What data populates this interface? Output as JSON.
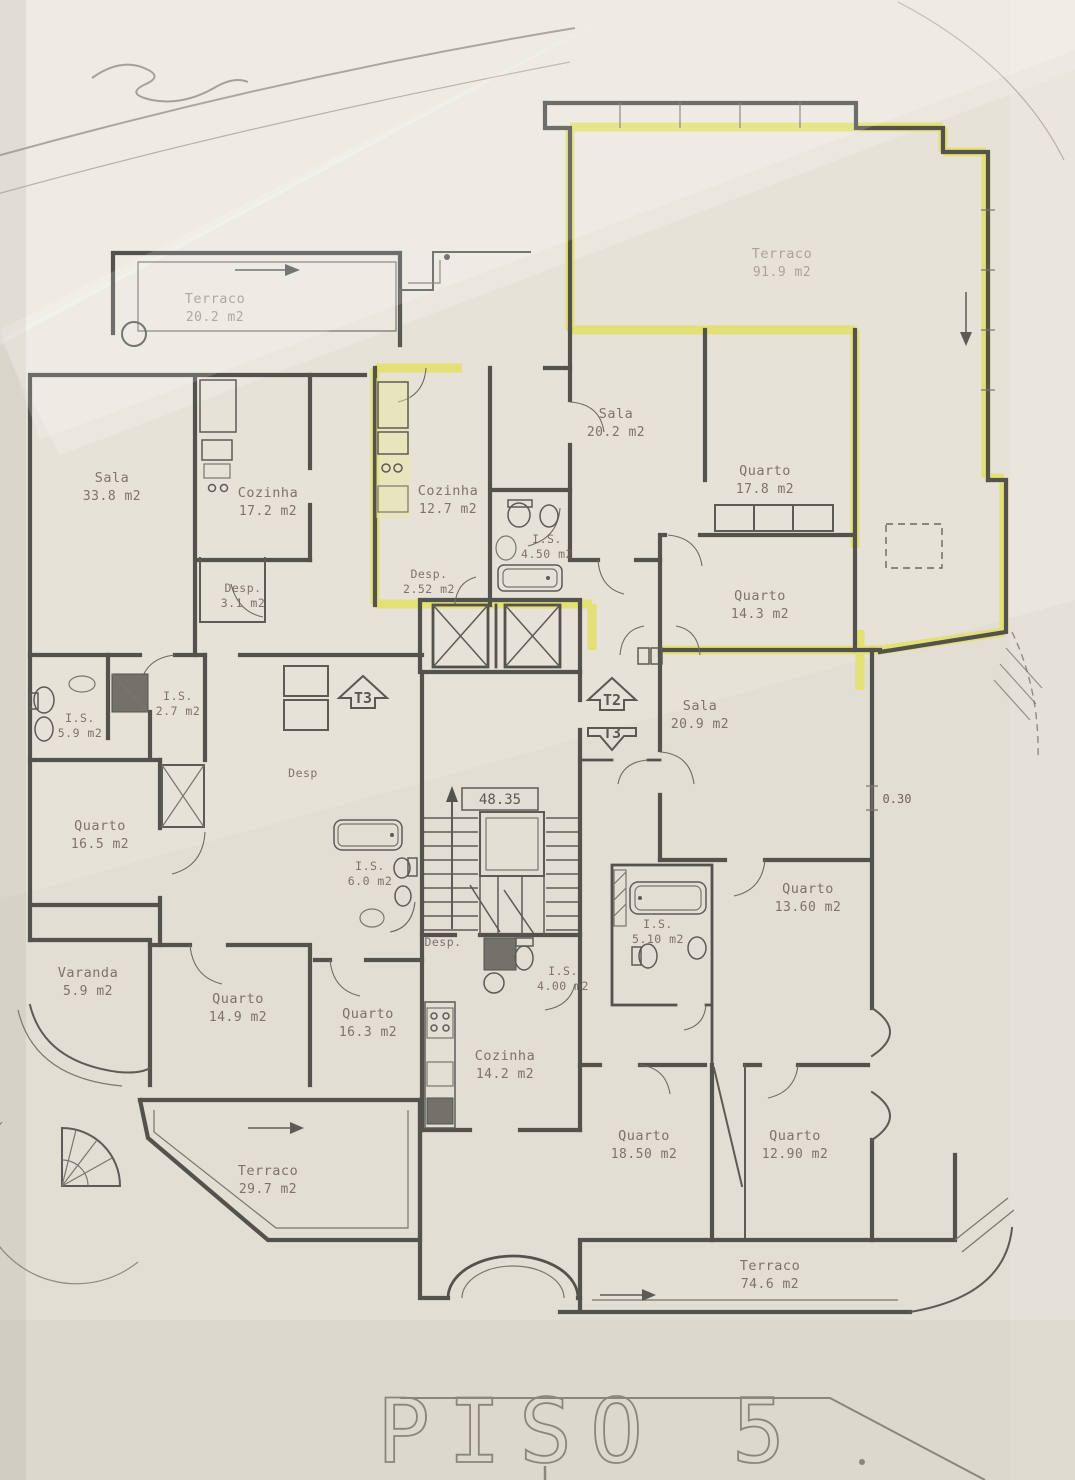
{
  "document": {
    "type_label": "architectural floor plan (scanned)",
    "title": "PISO 5"
  },
  "plan": {
    "rooms": {
      "terraco_nw": {
        "name": "Terraco",
        "area": "20.2 m2"
      },
      "terraco_ne": {
        "name": "Terraco",
        "area": "91.9 m2"
      },
      "sala_w": {
        "name": "Sala",
        "area": "33.8 m2"
      },
      "cozinha_w": {
        "name": "Cozinha",
        "area": "17.2 m2"
      },
      "cozinha_c": {
        "name": "Cozinha",
        "area": "12.7 m2"
      },
      "desp_c": {
        "name": "Desp.",
        "area": "2.52 m2"
      },
      "is_c": {
        "name": "I.S.",
        "area": "4.50 m2"
      },
      "sala_ne": {
        "name": "Sala",
        "area": "20.2 m2"
      },
      "quarto_ne": {
        "name": "Quarto",
        "area": "17.8 m2"
      },
      "quarto_e": {
        "name": "Quarto",
        "area": "14.3 m2"
      },
      "desp_w": {
        "name": "Desp.",
        "area": "3.1 m2"
      },
      "is_w1": {
        "name": "I.S.",
        "area": "5.9 m2"
      },
      "is_w2": {
        "name": "I.S.",
        "area": "2.7 m2"
      },
      "quarto_w": {
        "name": "Quarto",
        "area": "16.5 m2"
      },
      "desp_hall": {
        "name": "Desp",
        "area": ""
      },
      "is_center": {
        "name": "I.S.",
        "area": "6.0 m2"
      },
      "sala_e": {
        "name": "Sala",
        "area": "20.9 m2"
      },
      "quarto_se": {
        "name": "Quarto",
        "area": "13.60 m2"
      },
      "is_e": {
        "name": "I.S.",
        "area": "5.10 m2"
      },
      "varanda": {
        "name": "Varanda",
        "area": "5.9 m2"
      },
      "quarto_sw": {
        "name": "Quarto",
        "area": "14.9 m2"
      },
      "quarto_s1": {
        "name": "Quarto",
        "area": "16.3 m2"
      },
      "desp_s": {
        "name": "Desp.",
        "area": ""
      },
      "is_s": {
        "name": "I.S.",
        "area": "4.00 m2"
      },
      "cozinha_s": {
        "name": "Cozinha",
        "area": "14.2 m2"
      },
      "quarto_s2": {
        "name": "Quarto",
        "area": "18.50 m2"
      },
      "quarto_s3": {
        "name": "Quarto",
        "area": "12.90 m2"
      },
      "terraco_sw": {
        "name": "Terraco",
        "area": "29.7 m2"
      },
      "terraco_s": {
        "name": "Terraco",
        "area": "74.6 m2"
      }
    },
    "unit_tags": {
      "t3_hall": "T3",
      "t2": "T2",
      "t3_lower": "T3"
    },
    "annotations": {
      "stair_level": "48.35",
      "parapet_offset": "0.30"
    },
    "colors": {
      "highlight": "#e2e06b",
      "wall": "#54524d",
      "paper": "#e6e2d8",
      "ink": "#6f655e"
    }
  }
}
